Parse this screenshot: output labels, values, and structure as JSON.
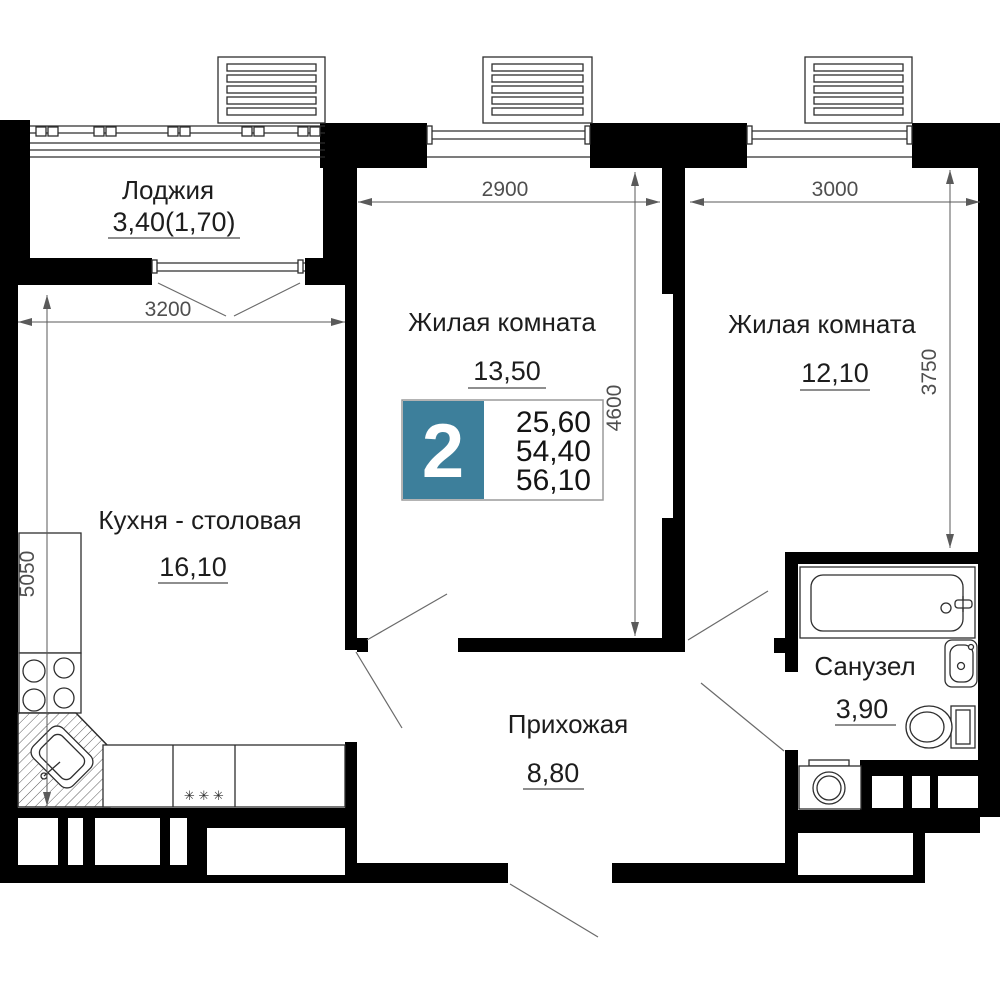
{
  "plan": {
    "badge": {
      "room_count": "2",
      "area_living": "25,60",
      "area_main": "54,40",
      "area_total": "56,10",
      "accent_color": "#3d7f9b"
    },
    "rooms": {
      "loggia": {
        "name": "Лоджия",
        "area": "3,40(1,70)"
      },
      "living1": {
        "name": "Жилая комната",
        "area": "13,50"
      },
      "living2": {
        "name": "Жилая комната",
        "area": "12,10"
      },
      "kitchen": {
        "name": "Кухня - столовая",
        "area": "16,10"
      },
      "hallway": {
        "name": "Прихожая",
        "area": "8,80"
      },
      "bathroom": {
        "name": "Санузел",
        "area": "3,90"
      }
    },
    "dimensions": {
      "living1_width": "2900",
      "living2_width": "3000",
      "kitchen_width": "3200",
      "kitchen_depth": "5050",
      "living1_depth": "4600",
      "living2_depth": "3750"
    },
    "decor": {
      "stove_marks": "✳ ✳ ✳"
    }
  }
}
